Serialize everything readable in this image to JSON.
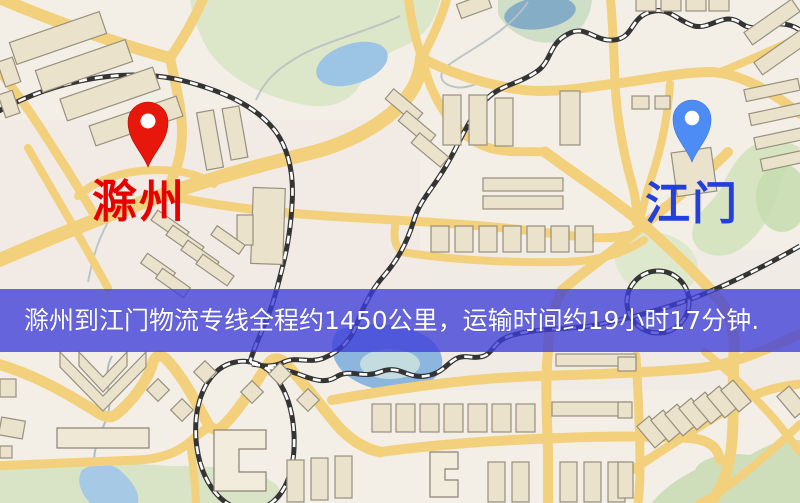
{
  "map": {
    "type": "street-map",
    "origin_marker": {
      "city": "滁州",
      "pin_color": "#e8170c",
      "label_color": "#e60000"
    },
    "destination_marker": {
      "city": "江门",
      "pin_color": "#4e8cf5",
      "label_color": "#2340dd"
    }
  },
  "banner": {
    "text": "滁州到江门物流专线全程约1450公里，运输时间约19小时17分钟.",
    "background_color": "rgba(62,62,216,0.78)",
    "text_color": "#ffffff",
    "route": {
      "from": "滁州",
      "to": "江门",
      "distance": "1450公里",
      "duration": "19小时17分钟"
    }
  }
}
